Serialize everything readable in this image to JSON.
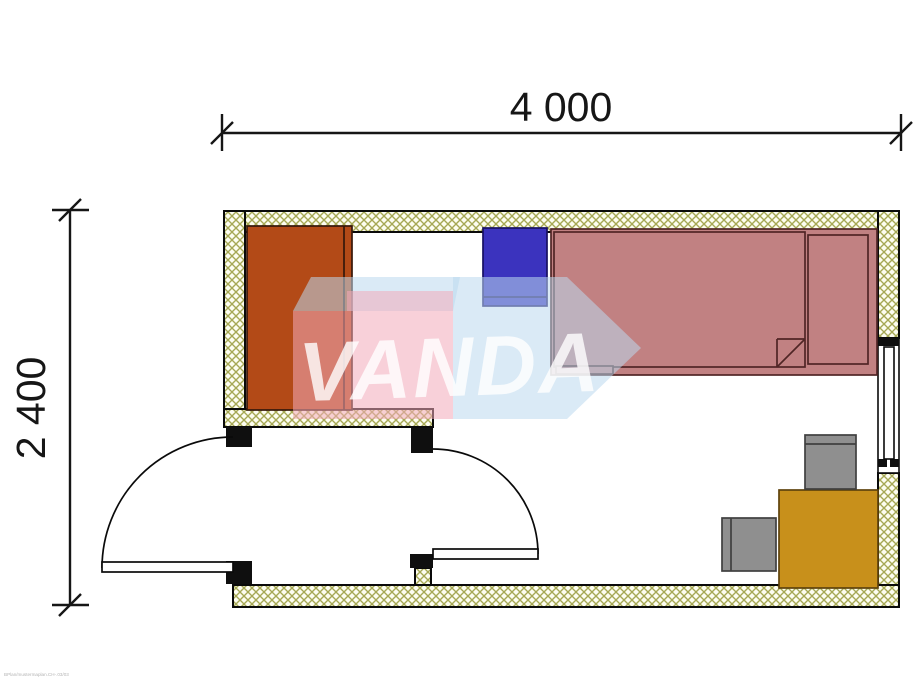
{
  "title": "room-floor-plan",
  "dimensions": {
    "width": {
      "label": "4 000",
      "x1": 222,
      "x2": 901,
      "y": 133,
      "label_x": 561,
      "label_y": 121
    },
    "height": {
      "label": "2 400",
      "y1": 210,
      "y2": 605,
      "x": 70,
      "label_x": 45,
      "label_y": 408
    }
  },
  "footer_note": "BPlan/mustermaplan.CH-.03/03",
  "palette": {
    "background": "#ffffff",
    "outline": "#0a0a0a",
    "dim_color": "#161616",
    "wall_bg": "#fdfdf0",
    "wall_hatch": "#a6a854",
    "jamb": "#0f0f0f",
    "wardrobe": "#b34a17",
    "wardrobe_border": "#36180a",
    "nightstand": "#3b33be",
    "nightstand_border": "#171063",
    "bed": "#c18182",
    "bed_border": "#502525",
    "table": "#c8901b",
    "table_border": "#5f430c",
    "chair": "#8f8f8f",
    "chair_border": "#3f3f3f",
    "door": "#ffffff",
    "footer_text": "#b5b5b5"
  },
  "plan": {
    "walls": [
      {
        "name": "wall-top",
        "x": 224,
        "y": 211,
        "w": 675,
        "h": 21
      },
      {
        "name": "wall-left",
        "x": 224,
        "y": 211,
        "w": 21,
        "h": 216
      },
      {
        "name": "wall-partition",
        "x": 224,
        "y": 409,
        "w": 209,
        "h": 18
      },
      {
        "name": "wall-right-upper",
        "x": 878,
        "y": 211,
        "w": 21,
        "h": 127
      },
      {
        "name": "wall-right-lower",
        "x": 878,
        "y": 473,
        "w": 21,
        "h": 134
      },
      {
        "name": "wall-bottom",
        "x": 233,
        "y": 585,
        "w": 666,
        "h": 22
      },
      {
        "name": "wall-door-post",
        "x": 415,
        "y": 568,
        "w": 16,
        "h": 17
      }
    ],
    "jambs": [
      {
        "name": "door-jamb",
        "x": 226,
        "y": 427,
        "w": 26,
        "h": 20
      },
      {
        "name": "door-jamb",
        "x": 411,
        "y": 428,
        "w": 22,
        "h": 25
      },
      {
        "name": "door-jamb",
        "x": 226,
        "y": 561,
        "w": 26,
        "h": 23
      },
      {
        "name": "door-jamb",
        "x": 410,
        "y": 554,
        "w": 23,
        "h": 14
      }
    ],
    "window": {
      "name": "window",
      "opening": {
        "x": 878,
        "y": 338,
        "w": 21,
        "h": 135
      },
      "caps": [
        {
          "x": 878,
          "y": 338,
          "w": 21,
          "h": 8
        },
        {
          "x": 878,
          "y": 459,
          "w": 9,
          "h": 8
        },
        {
          "x": 890,
          "y": 459,
          "w": 9,
          "h": 8
        }
      ],
      "frame": {
        "x": 884,
        "y": 347,
        "w": 10,
        "h": 112
      }
    },
    "doors": [
      {
        "name": "entrance-door",
        "leaf": {
          "x": 102,
          "y": 562,
          "w": 131,
          "h": 10
        },
        "arc": "M 233 437 A 131 131 0 0 0 102 568"
      },
      {
        "name": "interior-door",
        "leaf": {
          "x": 433,
          "y": 549,
          "w": 105,
          "h": 10
        },
        "arc": "M 433 449 A 105 105 0 0 1 538 554"
      }
    ],
    "furniture": [
      {
        "name": "wardrobe",
        "x": 247,
        "y": 226,
        "w": 105,
        "h": 184,
        "fill": "wardrobe",
        "stroke": "wardrobe_border",
        "lines": [
          [
            344,
            226,
            344,
            410
          ]
        ]
      },
      {
        "name": "nightstand",
        "x": 483,
        "y": 228,
        "w": 64,
        "h": 78,
        "fill": "nightstand",
        "stroke": "nightstand_border",
        "lines": [
          [
            483,
            297,
            547,
            297
          ]
        ]
      },
      {
        "name": "bed",
        "x": 551,
        "y": 229,
        "w": 326,
        "h": 146,
        "fill": "bed",
        "stroke": "bed_border",
        "lines": []
      },
      {
        "name": "bed-blanket",
        "x": 554,
        "y": 232,
        "w": 251,
        "h": 135,
        "fill": "bed",
        "stroke": "bed_border",
        "lines": [
          [
            777,
            339,
            805,
            339
          ],
          [
            777,
            339,
            777,
            367
          ],
          [
            777,
            367,
            805,
            339
          ]
        ]
      },
      {
        "name": "bed-pillow",
        "x": 808,
        "y": 235,
        "w": 60,
        "h": 129,
        "fill": "bed",
        "stroke": "bed_border",
        "lines": []
      },
      {
        "name": "bed-step",
        "x": 556,
        "y": 366,
        "w": 57,
        "h": 8,
        "fill": "bed",
        "stroke": "bed_border",
        "lines": []
      },
      {
        "name": "table",
        "x": 779,
        "y": 490,
        "w": 99,
        "h": 98,
        "fill": "table",
        "stroke": "table_border",
        "lines": []
      },
      {
        "name": "chair",
        "x": 805,
        "y": 435,
        "w": 51,
        "h": 54,
        "fill": "chair",
        "stroke": "chair_border",
        "lines": [
          [
            805,
            444,
            856,
            444
          ]
        ]
      },
      {
        "name": "chair",
        "x": 722,
        "y": 518,
        "w": 54,
        "h": 53,
        "fill": "chair",
        "stroke": "chair_border",
        "lines": [
          [
            731,
            518,
            731,
            571
          ]
        ]
      }
    ]
  },
  "watermark": {
    "text": "VANDA",
    "pink": "#f2a9ba",
    "blue": "#bcd9ef",
    "text_color": "#ffffff",
    "shape_opacity": 0.55,
    "text_opacity": 0.8,
    "blue_face": "293,311 311,277 460,277 453,311",
    "pink_rects": [
      {
        "x": 347,
        "y": 291,
        "w": 106,
        "h": 128
      },
      {
        "x": 293,
        "y": 311,
        "w": 54,
        "h": 108
      }
    ],
    "arrow": "453,277 567,277 641,348 567,419 453,419",
    "text_x": 298,
    "text_y": 396,
    "font_size": 84,
    "rotate": "-2 450 360"
  }
}
